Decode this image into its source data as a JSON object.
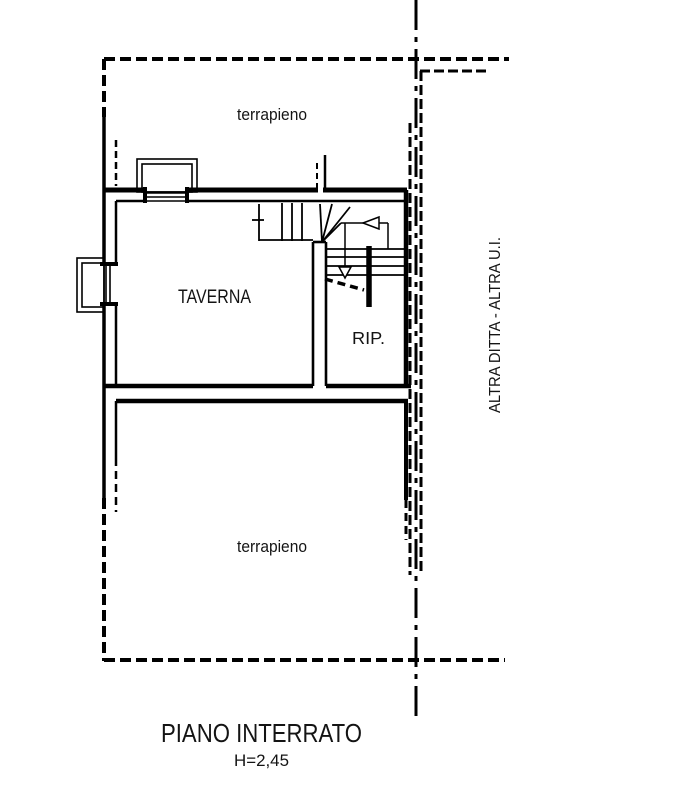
{
  "colors": {
    "line": "#000000",
    "text": "#141414",
    "background": "#ffffff"
  },
  "plan": {
    "title": "PIANO INTERRATO",
    "height_note": "H=2,45",
    "rooms": {
      "taverna": "TAVERNA",
      "rip": "RIP.",
      "terrapieno_top": "terrapieno",
      "terrapieno_bottom": "terrapieno"
    },
    "annotations": {
      "neighbor": "ALTRA DITTA - ALTRA U.I."
    }
  }
}
